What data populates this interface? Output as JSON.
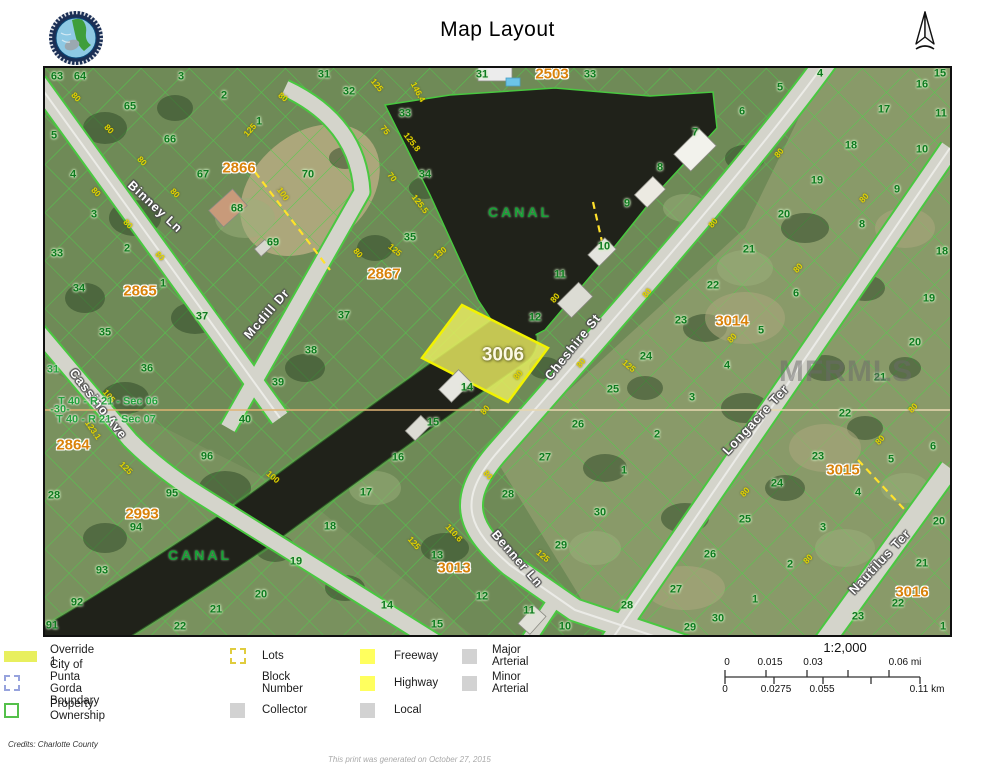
{
  "page": {
    "title": "Map Layout",
    "north_label": "N",
    "credits": "Credits: Charlotte County",
    "generated": "This print was generated on October 27, 2015"
  },
  "colors": {
    "lot_green": "#0e7a1f",
    "dimension_yellow": "#e3d400",
    "block_orange": "#d9820a",
    "parcel_line_green": "#4cd24a",
    "highlight_yellow": "#f2ee5c",
    "water_dark": "#2022168",
    "road_gray": "#d4d4cb"
  },
  "legend": {
    "columns": [
      [
        {
          "swatch": "override",
          "label": "Override 1"
        },
        {
          "swatch": "dashblue",
          "label": "City of Punta Gorda Boundary"
        },
        {
          "swatch": "outlinegreen",
          "label": "Property Ownership"
        }
      ],
      [
        {
          "swatch": "dashyellow",
          "label": "Lots"
        },
        {
          "swatch": "none",
          "label": "Block Number"
        },
        {
          "swatch": "gray",
          "label": "Collector"
        }
      ],
      [
        {
          "swatch": "yellow",
          "label": "Freeway"
        },
        {
          "swatch": "yellow",
          "label": "Highway"
        },
        {
          "swatch": "gray",
          "label": "Local"
        }
      ],
      [
        {
          "swatch": "gray",
          "label": "Major Arterial"
        },
        {
          "swatch": "gray",
          "label": "Minor Arterial"
        }
      ]
    ]
  },
  "scale": {
    "ratio": "1:2,000",
    "mi_labels": [
      {
        "t": "0",
        "x": 727
      },
      {
        "t": "0.015",
        "x": 770
      },
      {
        "t": "0.03",
        "x": 813
      },
      {
        "t": "0.06 mi",
        "x": 905
      }
    ],
    "km_labels": [
      {
        "t": "0",
        "x": 725
      },
      {
        "t": "0.0275",
        "x": 776
      },
      {
        "t": "0.055",
        "x": 822
      },
      {
        "t": "0.11 km",
        "x": 927
      }
    ],
    "bar": {
      "x1": 725,
      "x2": 920,
      "y": 677,
      "mi_ticks": [
        725,
        766,
        807,
        848,
        889
      ],
      "km_ticks": [
        725,
        774,
        823,
        871,
        920
      ]
    }
  },
  "map": {
    "watermark": {
      "t": "MFRMLS",
      "x": 846,
      "y": 372
    },
    "highlight_parcel": {
      "t": "3006",
      "x": 503,
      "y": 355
    },
    "canal_labels": [
      {
        "t": "CANAL",
        "x": 520,
        "y": 212
      },
      {
        "t": "CANAL",
        "x": 200,
        "y": 555
      }
    ],
    "street_labels": [
      {
        "t": "Binney Ln",
        "x": 155,
        "y": 207,
        "a": 43
      },
      {
        "t": "Mcdill Dr",
        "x": 267,
        "y": 314,
        "a": -49
      },
      {
        "t": "Cassino Ave",
        "x": 98,
        "y": 404,
        "a": 52
      },
      {
        "t": "Cheshire St",
        "x": 573,
        "y": 347,
        "a": -51
      },
      {
        "t": "Benner Ln",
        "x": 517,
        "y": 559,
        "a": 49
      },
      {
        "t": "Longacre Ter",
        "x": 756,
        "y": 420,
        "a": -47
      },
      {
        "t": "Nautilus Ter",
        "x": 880,
        "y": 562,
        "a": -47
      }
    ],
    "block_labels": [
      {
        "t": "2866",
        "x": 239,
        "y": 168
      },
      {
        "t": "2503",
        "x": 552,
        "y": 74
      },
      {
        "t": "2867",
        "x": 384,
        "y": 274
      },
      {
        "t": "2865",
        "x": 140,
        "y": 291
      },
      {
        "t": "2864",
        "x": 73,
        "y": 445
      },
      {
        "t": "2993",
        "x": 142,
        "y": 514
      },
      {
        "t": "3013",
        "x": 454,
        "y": 568
      },
      {
        "t": "3014",
        "x": 732,
        "y": 321
      },
      {
        "t": "3015",
        "x": 843,
        "y": 470
      },
      {
        "t": "3016",
        "x": 912,
        "y": 592
      }
    ],
    "section_labels": [
      {
        "t": "T 40 - R 21 - Sec 06",
        "x": 108,
        "y": 402
      },
      {
        "t": "T 40 - R 21 - Sec 07",
        "x": 106,
        "y": 420
      },
      {
        "t": "31",
        "x": 53,
        "y": 370
      },
      {
        "t": "-30-",
        "x": 60,
        "y": 410
      }
    ],
    "lot_labels": [
      {
        "t": "63",
        "x": 57,
        "y": 77
      },
      {
        "t": "64",
        "x": 80,
        "y": 77
      },
      {
        "t": "3",
        "x": 181,
        "y": 77
      },
      {
        "t": "2",
        "x": 224,
        "y": 96
      },
      {
        "t": "1",
        "x": 259,
        "y": 122
      },
      {
        "t": "65",
        "x": 130,
        "y": 107
      },
      {
        "t": "66",
        "x": 170,
        "y": 140
      },
      {
        "t": "67",
        "x": 203,
        "y": 175
      },
      {
        "t": "68",
        "x": 237,
        "y": 209
      },
      {
        "t": "69",
        "x": 273,
        "y": 243
      },
      {
        "t": "70",
        "x": 308,
        "y": 175
      },
      {
        "t": "31",
        "x": 324,
        "y": 75
      },
      {
        "t": "32",
        "x": 349,
        "y": 92
      },
      {
        "t": "5",
        "x": 54,
        "y": 136
      },
      {
        "t": "4",
        "x": 73,
        "y": 175
      },
      {
        "t": "3",
        "x": 94,
        "y": 215
      },
      {
        "t": "2",
        "x": 127,
        "y": 249
      },
      {
        "t": "33",
        "x": 57,
        "y": 254
      },
      {
        "t": "34",
        "x": 79,
        "y": 289
      },
      {
        "t": "35",
        "x": 105,
        "y": 333
      },
      {
        "t": "36",
        "x": 147,
        "y": 369
      },
      {
        "t": "28",
        "x": 54,
        "y": 496
      },
      {
        "t": "1",
        "x": 163,
        "y": 284
      },
      {
        "t": "37",
        "x": 202,
        "y": 317
      },
      {
        "t": "37",
        "x": 344,
        "y": 316
      },
      {
        "t": "38",
        "x": 311,
        "y": 351
      },
      {
        "t": "39",
        "x": 278,
        "y": 383
      },
      {
        "t": "40",
        "x": 245,
        "y": 420
      },
      {
        "t": "33",
        "x": 405,
        "y": 114
      },
      {
        "t": "34",
        "x": 425,
        "y": 175
      },
      {
        "t": "35",
        "x": 410,
        "y": 238
      },
      {
        "t": "31",
        "x": 482,
        "y": 75
      },
      {
        "t": "33",
        "x": 590,
        "y": 75
      },
      {
        "t": "8",
        "x": 660,
        "y": 168
      },
      {
        "t": "9",
        "x": 627,
        "y": 204
      },
      {
        "t": "10",
        "x": 604,
        "y": 247
      },
      {
        "t": "11",
        "x": 560,
        "y": 275
      },
      {
        "t": "12",
        "x": 535,
        "y": 318
      },
      {
        "t": "14",
        "x": 467,
        "y": 388
      },
      {
        "t": "15",
        "x": 433,
        "y": 423
      },
      {
        "t": "7",
        "x": 695,
        "y": 133
      },
      {
        "t": "6",
        "x": 742,
        "y": 112
      },
      {
        "t": "5",
        "x": 780,
        "y": 88
      },
      {
        "t": "4",
        "x": 820,
        "y": 74
      },
      {
        "t": "15",
        "x": 940,
        "y": 74
      },
      {
        "t": "16",
        "x": 922,
        "y": 85
      },
      {
        "t": "17",
        "x": 884,
        "y": 110
      },
      {
        "t": "18",
        "x": 851,
        "y": 146
      },
      {
        "t": "19",
        "x": 817,
        "y": 181
      },
      {
        "t": "20",
        "x": 784,
        "y": 215
      },
      {
        "t": "21",
        "x": 749,
        "y": 250
      },
      {
        "t": "11",
        "x": 941,
        "y": 114
      },
      {
        "t": "10",
        "x": 922,
        "y": 150
      },
      {
        "t": "9",
        "x": 897,
        "y": 190
      },
      {
        "t": "8",
        "x": 862,
        "y": 225
      },
      {
        "t": "18",
        "x": 942,
        "y": 252
      },
      {
        "t": "22",
        "x": 713,
        "y": 286
      },
      {
        "t": "23",
        "x": 681,
        "y": 321
      },
      {
        "t": "24",
        "x": 646,
        "y": 357
      },
      {
        "t": "25",
        "x": 613,
        "y": 390
      },
      {
        "t": "26",
        "x": 578,
        "y": 425
      },
      {
        "t": "27",
        "x": 545,
        "y": 458
      },
      {
        "t": "2",
        "x": 657,
        "y": 435
      },
      {
        "t": "3",
        "x": 692,
        "y": 398
      },
      {
        "t": "4",
        "x": 727,
        "y": 366
      },
      {
        "t": "5",
        "x": 761,
        "y": 331
      },
      {
        "t": "6",
        "x": 796,
        "y": 294
      },
      {
        "t": "19",
        "x": 929,
        "y": 299
      },
      {
        "t": "20",
        "x": 915,
        "y": 343
      },
      {
        "t": "21",
        "x": 880,
        "y": 378
      },
      {
        "t": "22",
        "x": 845,
        "y": 414
      },
      {
        "t": "23",
        "x": 818,
        "y": 457
      },
      {
        "t": "24",
        "x": 777,
        "y": 484
      },
      {
        "t": "25",
        "x": 745,
        "y": 520
      },
      {
        "t": "26",
        "x": 710,
        "y": 555
      },
      {
        "t": "5",
        "x": 891,
        "y": 460
      },
      {
        "t": "4",
        "x": 858,
        "y": 493
      },
      {
        "t": "3",
        "x": 823,
        "y": 528
      },
      {
        "t": "2",
        "x": 790,
        "y": 565
      },
      {
        "t": "1",
        "x": 755,
        "y": 600
      },
      {
        "t": "6",
        "x": 933,
        "y": 447
      },
      {
        "t": "20",
        "x": 939,
        "y": 522
      },
      {
        "t": "21",
        "x": 922,
        "y": 564
      },
      {
        "t": "22",
        "x": 898,
        "y": 604
      },
      {
        "t": "23",
        "x": 858,
        "y": 617
      },
      {
        "t": "1",
        "x": 943,
        "y": 627
      },
      {
        "t": "29",
        "x": 690,
        "y": 628
      },
      {
        "t": "30",
        "x": 718,
        "y": 619
      },
      {
        "t": "1",
        "x": 624,
        "y": 471
      },
      {
        "t": "30",
        "x": 600,
        "y": 513
      },
      {
        "t": "29",
        "x": 561,
        "y": 546
      },
      {
        "t": "28",
        "x": 508,
        "y": 495
      },
      {
        "t": "27",
        "x": 676,
        "y": 590
      },
      {
        "t": "28",
        "x": 627,
        "y": 606
      },
      {
        "t": "16",
        "x": 398,
        "y": 458
      },
      {
        "t": "17",
        "x": 366,
        "y": 493
      },
      {
        "t": "13",
        "x": 437,
        "y": 556
      },
      {
        "t": "12",
        "x": 482,
        "y": 597
      },
      {
        "t": "14",
        "x": 387,
        "y": 606
      },
      {
        "t": "15",
        "x": 437,
        "y": 625
      },
      {
        "t": "11",
        "x": 529,
        "y": 611
      },
      {
        "t": "10",
        "x": 565,
        "y": 627
      },
      {
        "t": "96",
        "x": 207,
        "y": 457
      },
      {
        "t": "95",
        "x": 172,
        "y": 494
      },
      {
        "t": "94",
        "x": 136,
        "y": 528
      },
      {
        "t": "93",
        "x": 102,
        "y": 571
      },
      {
        "t": "92",
        "x": 77,
        "y": 603
      },
      {
        "t": "91",
        "x": 52,
        "y": 626
      },
      {
        "t": "18",
        "x": 330,
        "y": 527
      },
      {
        "t": "19",
        "x": 296,
        "y": 562
      },
      {
        "t": "20",
        "x": 261,
        "y": 595
      },
      {
        "t": "21",
        "x": 216,
        "y": 610
      },
      {
        "t": "22",
        "x": 180,
        "y": 627
      }
    ],
    "dimension_labels": [
      {
        "t": "80",
        "x": 76,
        "y": 97,
        "a": 45
      },
      {
        "t": "80",
        "x": 109,
        "y": 129,
        "a": 45
      },
      {
        "t": "80",
        "x": 142,
        "y": 161,
        "a": 45
      },
      {
        "t": "80",
        "x": 175,
        "y": 193,
        "a": 45
      },
      {
        "t": "80",
        "x": 96,
        "y": 192,
        "a": 45
      },
      {
        "t": "80",
        "x": 128,
        "y": 224,
        "a": 45
      },
      {
        "t": "80",
        "x": 160,
        "y": 256,
        "a": 45
      },
      {
        "t": "80",
        "x": 283,
        "y": 97,
        "a": 40
      },
      {
        "t": "125",
        "x": 250,
        "y": 130,
        "a": -48
      },
      {
        "t": "100",
        "x": 283,
        "y": 194,
        "a": 55
      },
      {
        "t": "146.4",
        "x": 418,
        "y": 92,
        "a": 62
      },
      {
        "t": "125.8",
        "x": 412,
        "y": 142,
        "a": 52
      },
      {
        "t": "125.5",
        "x": 420,
        "y": 204,
        "a": 52
      },
      {
        "t": "75",
        "x": 385,
        "y": 130,
        "a": 52
      },
      {
        "t": "70",
        "x": 392,
        "y": 177,
        "a": 52
      },
      {
        "t": "125",
        "x": 377,
        "y": 85,
        "a": 50
      },
      {
        "t": "130",
        "x": 440,
        "y": 253,
        "a": -40
      },
      {
        "t": "125",
        "x": 395,
        "y": 250,
        "a": 40
      },
      {
        "t": "80",
        "x": 358,
        "y": 253,
        "a": 50
      },
      {
        "t": "105",
        "x": 109,
        "y": 396,
        "a": 50
      },
      {
        "t": "123.1",
        "x": 93,
        "y": 430,
        "a": 55
      },
      {
        "t": "100",
        "x": 273,
        "y": 477,
        "a": 40
      },
      {
        "t": "125",
        "x": 126,
        "y": 468,
        "a": 45
      },
      {
        "t": "80",
        "x": 555,
        "y": 298,
        "a": -50
      },
      {
        "t": "80",
        "x": 581,
        "y": 363,
        "a": -50
      },
      {
        "t": "80",
        "x": 647,
        "y": 293,
        "a": -50
      },
      {
        "t": "80",
        "x": 713,
        "y": 223,
        "a": -50
      },
      {
        "t": "80",
        "x": 779,
        "y": 153,
        "a": -50
      },
      {
        "t": "80",
        "x": 518,
        "y": 375,
        "a": -50
      },
      {
        "t": "80",
        "x": 485,
        "y": 410,
        "a": -50
      },
      {
        "t": "125",
        "x": 629,
        "y": 366,
        "a": 40
      },
      {
        "t": "125",
        "x": 543,
        "y": 556,
        "a": 40
      },
      {
        "t": "110.6",
        "x": 454,
        "y": 533,
        "a": 48
      },
      {
        "t": "125",
        "x": 414,
        "y": 543,
        "a": 48
      },
      {
        "t": "80",
        "x": 488,
        "y": 475,
        "a": 48
      },
      {
        "t": "80",
        "x": 732,
        "y": 338,
        "a": -48
      },
      {
        "t": "80",
        "x": 798,
        "y": 268,
        "a": -48
      },
      {
        "t": "80",
        "x": 864,
        "y": 198,
        "a": -48
      },
      {
        "t": "80",
        "x": 880,
        "y": 440,
        "a": -48
      },
      {
        "t": "80",
        "x": 745,
        "y": 492,
        "a": -48
      },
      {
        "t": "80",
        "x": 808,
        "y": 559,
        "a": -48
      },
      {
        "t": "80",
        "x": 913,
        "y": 408,
        "a": -48
      }
    ]
  }
}
